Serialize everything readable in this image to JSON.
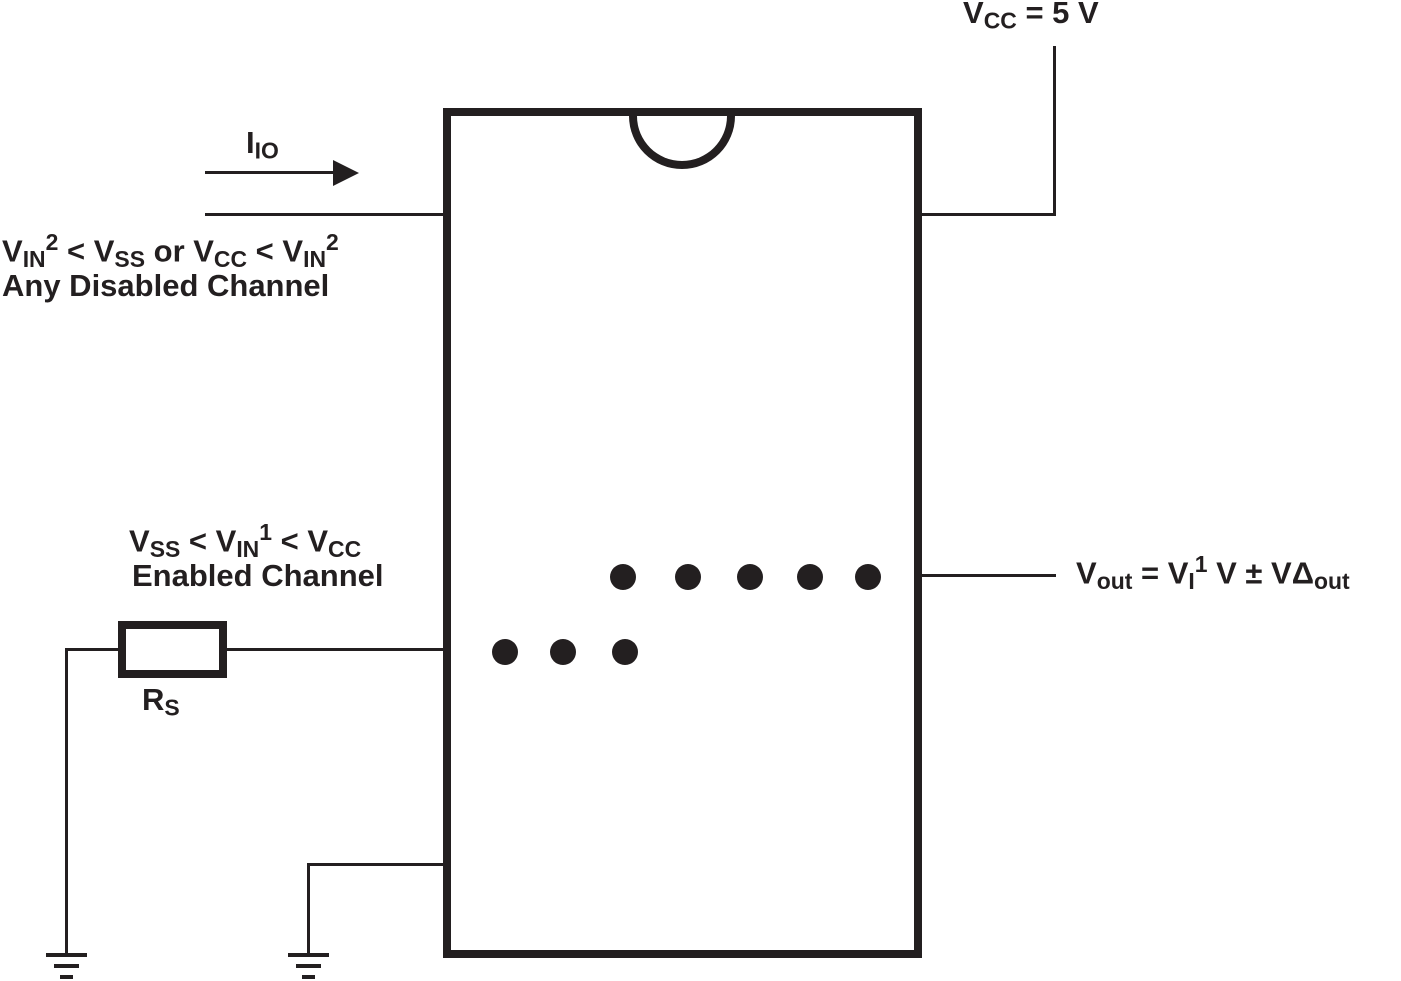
{
  "colors": {
    "ink": "#231f20",
    "background": "#ffffff"
  },
  "labels": {
    "vcc": {
      "v": "V",
      "sub": "CC",
      "rest": " = 5 V"
    },
    "iio": {
      "i": "I",
      "sub": "IO"
    },
    "disabled": {
      "eq": {
        "v1": "V",
        "s1": "IN",
        "sup1": "2",
        "m1": " < V",
        "s2": "SS",
        "m2": " or V",
        "s3": "CC",
        "m3": " < V",
        "s4": "IN",
        "sup2": "2"
      },
      "caption": "Any Disabled Channel"
    },
    "enabled": {
      "eq": {
        "v1": "V",
        "s1": "SS",
        "m1": " < V",
        "s2": "IN",
        "sup1": "1",
        "m2": " < V",
        "s3": "CC"
      },
      "caption": "Enabled Channel"
    },
    "resistor": {
      "r": "R",
      "s": "S"
    },
    "vout": {
      "v1": "V",
      "s1": "out",
      "m1": " = V",
      "s2": "I",
      "sup1": "1",
      "m2": " V ± VΔ",
      "s3": "out"
    }
  }
}
